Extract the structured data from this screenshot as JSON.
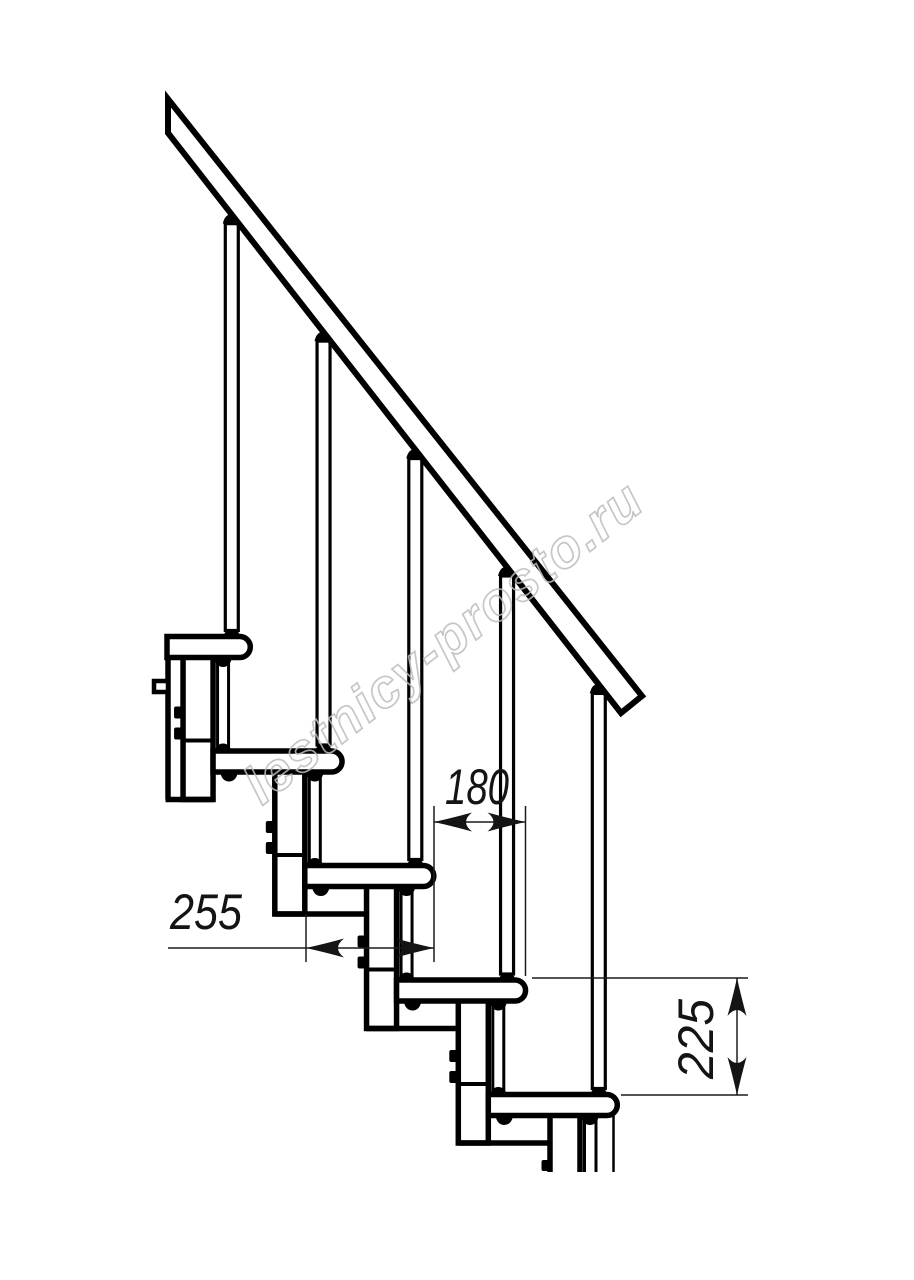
{
  "watermark": {
    "text": "lestnicy-prosto.ru",
    "color": "#bdbdbd"
  },
  "dimensions": {
    "tread_depth": {
      "value": "255"
    },
    "going": {
      "value": "180"
    },
    "rise": {
      "value": "225"
    }
  },
  "colors": {
    "background": "#ffffff",
    "linework": "#000000",
    "dimension": "#1c1c1c"
  }
}
